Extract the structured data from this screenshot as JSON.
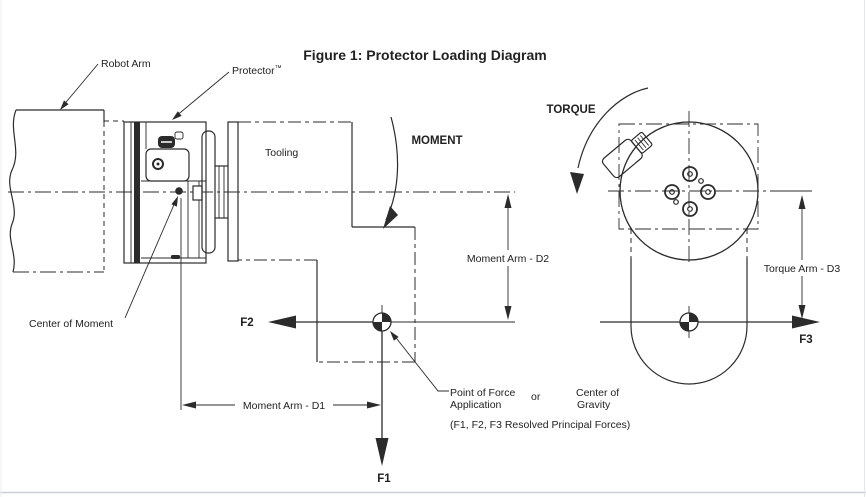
{
  "title": "Figure 1: Protector Loading Diagram",
  "labels": {
    "robot_arm": "Robot Arm",
    "protector": "Protector",
    "protector_tm": "™",
    "tooling": "Tooling",
    "moment": "MOMENT",
    "torque": "TORQUE",
    "center_of_moment": "Center of Moment",
    "point_of_force_1": "Point of Force",
    "point_of_force_2": "Application",
    "or": "or",
    "center_of_gravity_1": "Center of",
    "center_of_gravity_2": "Gravity",
    "resolved_note": "(F1, F2, F3 Resolved Principal Forces)"
  },
  "dimensions": {
    "d1": "Moment Arm - D1",
    "d2": "Moment Arm - D2",
    "d3": "Torque Arm - D3"
  },
  "forces": {
    "f1": "F1",
    "f2": "F2",
    "f3": "F3"
  },
  "colors": {
    "line": "#2b2b2b",
    "background": "#ffffff",
    "page_border": "#c9cfd6"
  }
}
